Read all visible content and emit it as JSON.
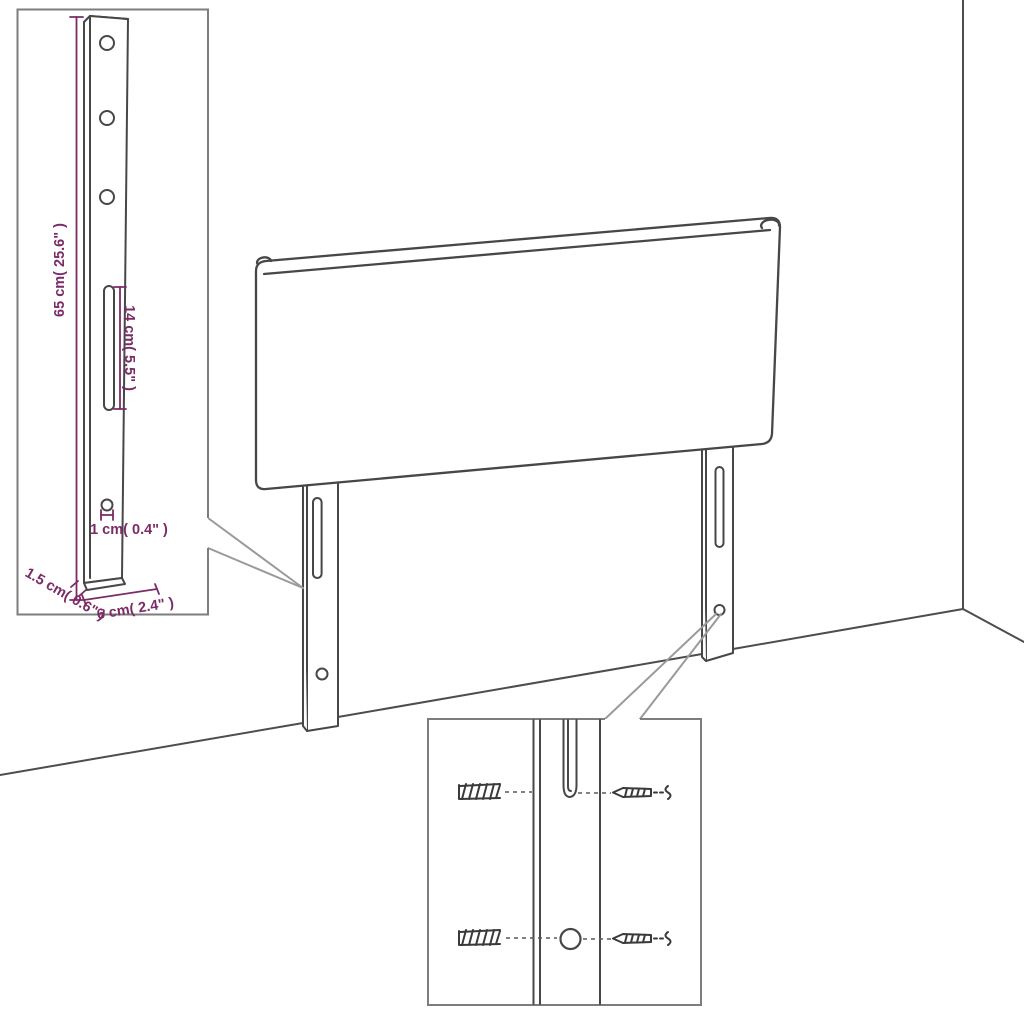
{
  "colors": {
    "dimension_text": "#7b2b66",
    "drawing_line": "#474747",
    "inset_border": "#7d7d7d",
    "callout_line": "#9a9a9a",
    "background": "#ffffff"
  },
  "insets": {
    "leg_detail": {
      "dim_height": "65 cm( 25.6\" )",
      "dim_slot": "14 cm( 5.5\" )",
      "dim_hole": "1 cm( 0.4\" )",
      "dim_thickness": "1.5 cm( 0.6\" )",
      "dim_width": "6 cm( 2.4\" )"
    }
  }
}
